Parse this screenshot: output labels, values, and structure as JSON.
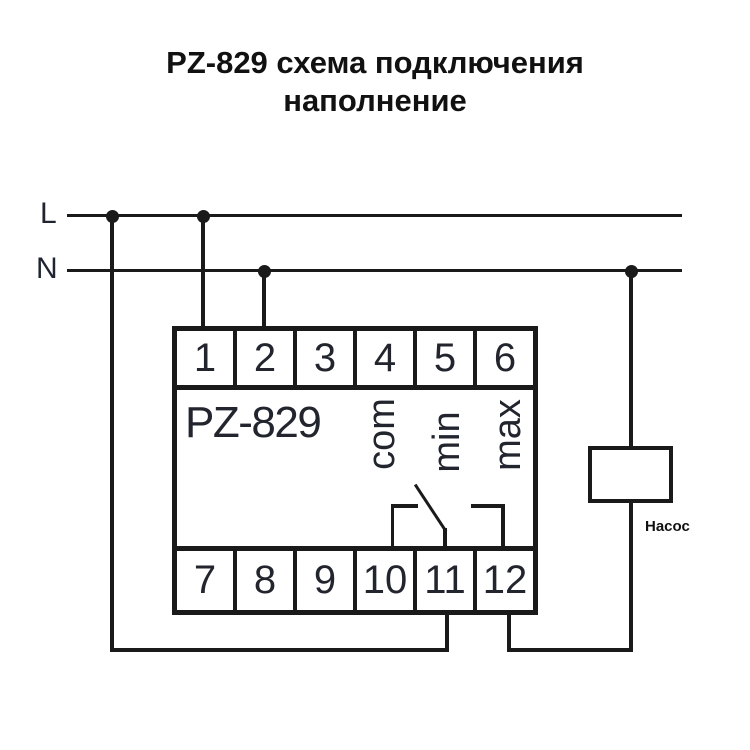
{
  "title": {
    "line1": "PZ-829 схема подключения",
    "line2": "наполнение"
  },
  "power": {
    "l_label": "L",
    "n_label": "N"
  },
  "device": {
    "model": "PZ-829",
    "top_terminals": [
      "1",
      "2",
      "3",
      "4",
      "5",
      "6"
    ],
    "bottom_terminals": [
      "7",
      "8",
      "9",
      "10",
      "11",
      "12"
    ],
    "contact_labels": [
      "com",
      "min",
      "max"
    ]
  },
  "load": {
    "label": "Насос"
  },
  "colors": {
    "line": "#1a1a1a",
    "background": "#ffffff"
  }
}
